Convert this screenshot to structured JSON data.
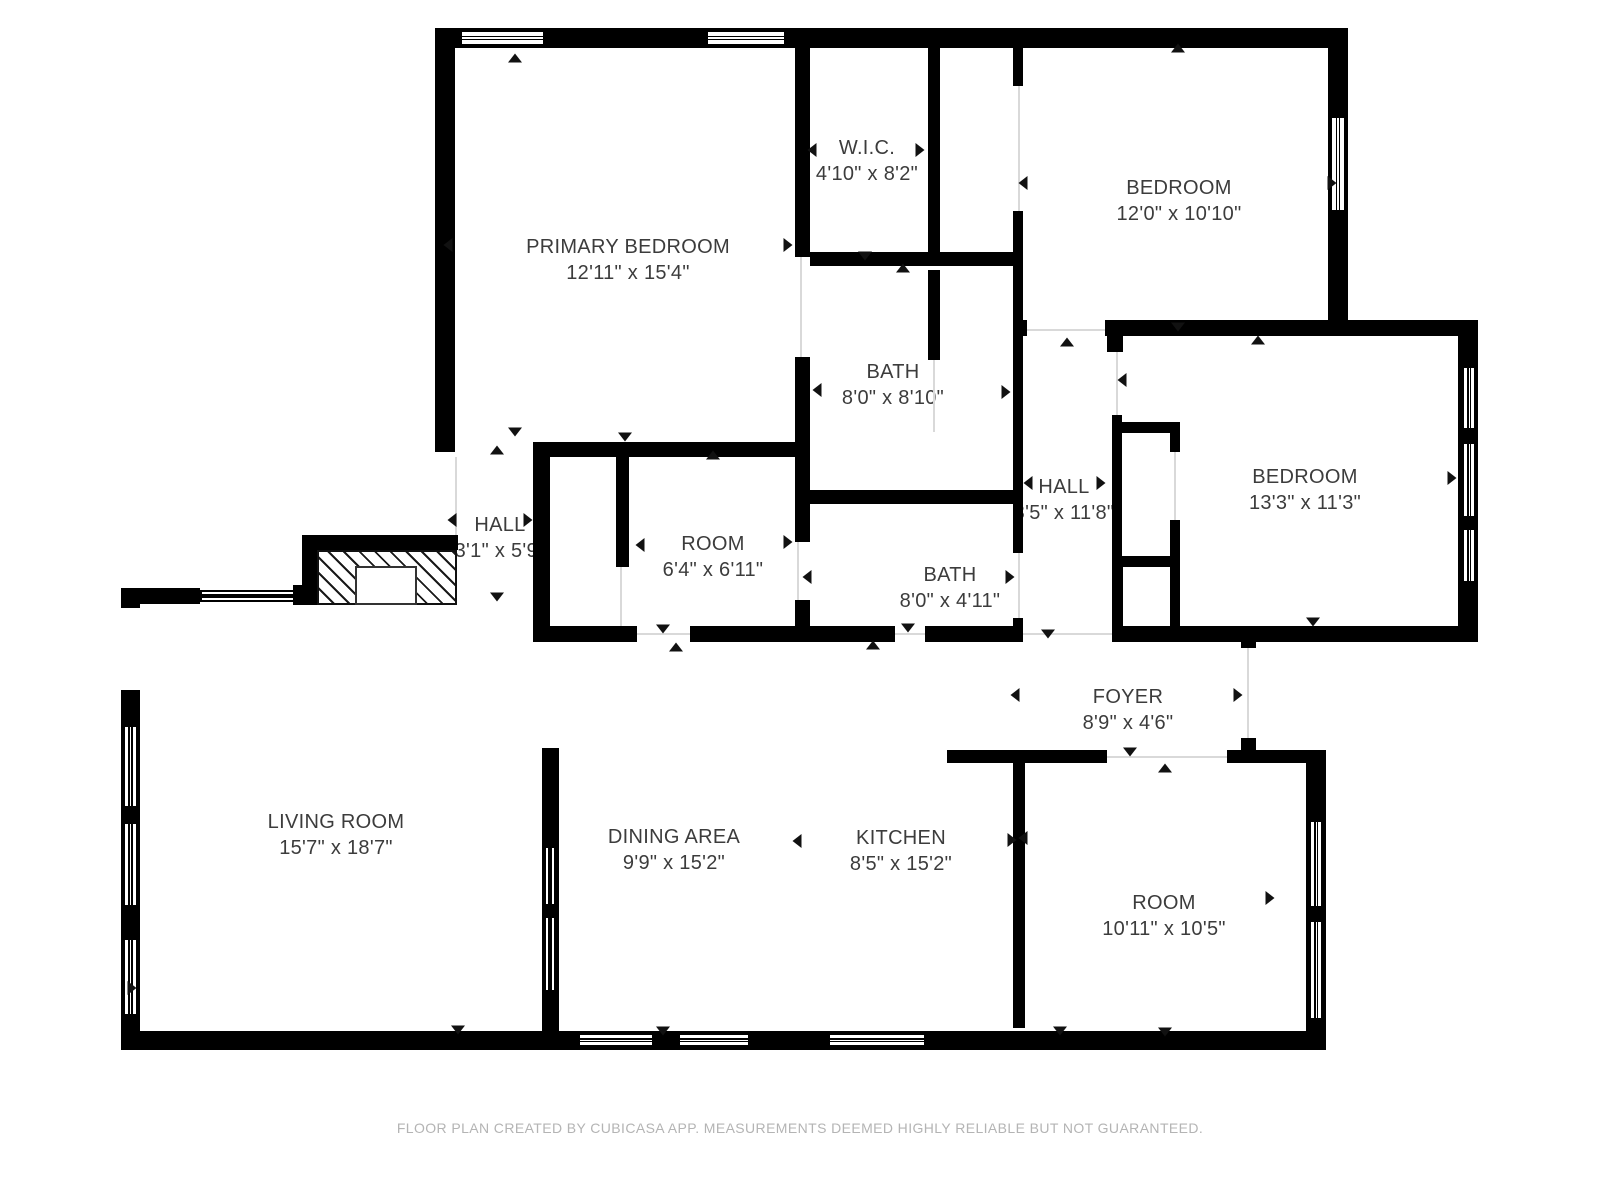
{
  "footer": {
    "text": "FLOOR PLAN CREATED BY CUBICASA APP. MEASUREMENTS DEEMED HIGHLY RELIABLE BUT NOT GUARANTEED."
  },
  "colors": {
    "wall": "#000000",
    "floor": "#ffffff",
    "label_text": "#3c3c3c",
    "marker": "#111111",
    "opening_line": "#d9d9d9",
    "footer_text": "#b4b4b4"
  },
  "rooms": [
    {
      "id": "primary-bedroom",
      "name": "PRIMARY BEDROOM",
      "dims": "12'11\" x 15'4\"",
      "cx": 628,
      "cy": 260
    },
    {
      "id": "wic",
      "name": "W.I.C.",
      "dims": "4'10\" x 8'2\"",
      "cx": 867,
      "cy": 161
    },
    {
      "id": "bedroom-top-right",
      "name": "BEDROOM",
      "dims": "12'0\" x 10'10\"",
      "cx": 1179,
      "cy": 201
    },
    {
      "id": "bath-upper",
      "name": "BATH",
      "dims": "8'0\" x 8'10\"",
      "cx": 893,
      "cy": 385
    },
    {
      "id": "hall-right",
      "name": "HALL",
      "dims": "3'5\" x 11'8\"",
      "cx": 1064,
      "cy": 500
    },
    {
      "id": "bedroom-right",
      "name": "BEDROOM",
      "dims": "13'3\" x 11'3\"",
      "cx": 1305,
      "cy": 490
    },
    {
      "id": "hall-left",
      "name": "HALL",
      "dims": "3'1\" x 5'9\"",
      "cx": 500,
      "cy": 538
    },
    {
      "id": "room-small",
      "name": "ROOM",
      "dims": "6'4\" x 6'11\"",
      "cx": 713,
      "cy": 557
    },
    {
      "id": "bath-lower",
      "name": "BATH",
      "dims": "8'0\" x 4'11\"",
      "cx": 950,
      "cy": 588
    },
    {
      "id": "foyer",
      "name": "FOYER",
      "dims": "8'9\" x 4'6\"",
      "cx": 1128,
      "cy": 710
    },
    {
      "id": "living-room",
      "name": "LIVING ROOM",
      "dims": "15'7\" x 18'7\"",
      "cx": 336,
      "cy": 835
    },
    {
      "id": "dining-area",
      "name": "DINING AREA",
      "dims": "9'9\" x 15'2\"",
      "cx": 674,
      "cy": 850
    },
    {
      "id": "kitchen",
      "name": "KITCHEN",
      "dims": "8'5\" x 15'2\"",
      "cx": 901,
      "cy": 851
    },
    {
      "id": "room-lower",
      "name": "ROOM",
      "dims": "10'11\" x 10'5\"",
      "cx": 1164,
      "cy": 916
    }
  ],
  "plan": {
    "walls": [
      [
        435,
        28,
        913,
        20
      ],
      [
        435,
        28,
        20,
        424
      ],
      [
        1328,
        28,
        20,
        308
      ],
      [
        1105,
        320,
        373,
        16
      ],
      [
        1013,
        320,
        14,
        16
      ],
      [
        1458,
        320,
        20,
        322
      ],
      [
        1112,
        626,
        366,
        16
      ],
      [
        795,
        48,
        15,
        209
      ],
      [
        795,
        357,
        15,
        100
      ],
      [
        928,
        28,
        12,
        230
      ],
      [
        928,
        270,
        12,
        90
      ],
      [
        1013,
        28,
        10,
        58
      ],
      [
        1013,
        211,
        10,
        109
      ],
      [
        1013,
        336,
        10,
        217
      ],
      [
        1013,
        618,
        10,
        24
      ],
      [
        810,
        252,
        213,
        14
      ],
      [
        795,
        490,
        228,
        14
      ],
      [
        533,
        442,
        277,
        15
      ],
      [
        533,
        457,
        17,
        185
      ],
      [
        616,
        457,
        13,
        110
      ],
      [
        795,
        457,
        15,
        85
      ],
      [
        795,
        600,
        15,
        42
      ],
      [
        533,
        626,
        104,
        16
      ],
      [
        690,
        626,
        205,
        16
      ],
      [
        925,
        626,
        98,
        16
      ],
      [
        1107,
        336,
        16,
        16
      ],
      [
        1112,
        415,
        10,
        152
      ],
      [
        1112,
        567,
        11,
        59
      ],
      [
        1112,
        422,
        68,
        11
      ],
      [
        1170,
        422,
        10,
        30
      ],
      [
        1170,
        520,
        10,
        47
      ],
      [
        1112,
        556,
        68,
        11
      ],
      [
        1170,
        567,
        10,
        59
      ],
      [
        1241,
        628,
        15,
        20
      ],
      [
        1241,
        738,
        15,
        14
      ],
      [
        947,
        750,
        160,
        13
      ],
      [
        1227,
        750,
        99,
        13
      ],
      [
        1306,
        750,
        20,
        300
      ],
      [
        1013,
        750,
        12,
        278
      ],
      [
        121,
        588,
        79,
        16
      ],
      [
        121,
        588,
        19,
        462
      ],
      [
        121,
        1031,
        1205,
        19
      ],
      [
        542,
        748,
        17,
        285
      ]
    ],
    "holes": [
      [
        121,
        608,
        19,
        82
      ]
    ],
    "windows": [
      [
        460,
        30,
        85,
        16,
        "h"
      ],
      [
        706,
        30,
        80,
        16,
        "h"
      ],
      [
        1330,
        116,
        16,
        96,
        "v"
      ],
      [
        1462,
        366,
        14,
        64,
        "v"
      ],
      [
        1462,
        442,
        14,
        76,
        "v"
      ],
      [
        1462,
        528,
        14,
        55,
        "v"
      ],
      [
        200,
        590,
        95,
        12,
        "h"
      ],
      [
        123,
        725,
        15,
        83,
        "v"
      ],
      [
        123,
        822,
        15,
        85,
        "v"
      ],
      [
        123,
        938,
        15,
        78,
        "v"
      ],
      [
        578,
        1033,
        76,
        14,
        "h"
      ],
      [
        678,
        1033,
        72,
        14,
        "h"
      ],
      [
        828,
        1033,
        98,
        14,
        "h"
      ],
      [
        1309,
        820,
        14,
        88,
        "v"
      ],
      [
        1309,
        920,
        14,
        100,
        "v"
      ],
      [
        544,
        846,
        12,
        60,
        "v"
      ],
      [
        544,
        916,
        12,
        76,
        "v"
      ]
    ],
    "openings": [
      [
        455,
        457,
        2,
        93
      ],
      [
        800,
        257,
        2,
        100
      ],
      [
        933,
        360,
        2,
        72
      ],
      [
        1018,
        86,
        2,
        125
      ],
      [
        1027,
        329,
        78,
        2
      ],
      [
        1116,
        352,
        2,
        63
      ],
      [
        1174,
        452,
        2,
        68
      ],
      [
        637,
        633,
        53,
        2
      ],
      [
        1018,
        553,
        2,
        65
      ],
      [
        1023,
        633,
        89,
        2
      ],
      [
        1107,
        756,
        120,
        2
      ],
      [
        895,
        633,
        30,
        2
      ],
      [
        797,
        542,
        2,
        58
      ],
      [
        620,
        567,
        2,
        59
      ],
      [
        125,
        608,
        2,
        82
      ],
      [
        1247,
        648,
        2,
        94
      ]
    ],
    "markers": [
      [
        515,
        58,
        "u"
      ],
      [
        1178,
        48,
        "u"
      ],
      [
        812,
        150,
        "l"
      ],
      [
        920,
        150,
        "r"
      ],
      [
        448,
        245,
        "l"
      ],
      [
        788,
        245,
        "r"
      ],
      [
        515,
        432,
        "d"
      ],
      [
        1023,
        183,
        "l"
      ],
      [
        1332,
        183,
        "r"
      ],
      [
        865,
        256,
        "d"
      ],
      [
        903,
        268,
        "u"
      ],
      [
        1067,
        342,
        "u"
      ],
      [
        1178,
        327,
        "d"
      ],
      [
        1122,
        380,
        "l"
      ],
      [
        1452,
        478,
        "r"
      ],
      [
        1258,
        340,
        "u"
      ],
      [
        1313,
        622,
        "d"
      ],
      [
        1028,
        483,
        "l"
      ],
      [
        1101,
        483,
        "r"
      ],
      [
        817,
        390,
        "l"
      ],
      [
        1006,
        392,
        "r"
      ],
      [
        452,
        520,
        "l"
      ],
      [
        528,
        520,
        "r"
      ],
      [
        497,
        450,
        "u"
      ],
      [
        497,
        597,
        "d"
      ],
      [
        640,
        545,
        "l"
      ],
      [
        788,
        542,
        "r"
      ],
      [
        625,
        437,
        "d"
      ],
      [
        713,
        455,
        "u"
      ],
      [
        663,
        629,
        "d"
      ],
      [
        676,
        647,
        "u"
      ],
      [
        807,
        577,
        "l"
      ],
      [
        1010,
        577,
        "r"
      ],
      [
        908,
        628,
        "d"
      ],
      [
        873,
        645,
        "u"
      ],
      [
        1048,
        634,
        "d"
      ],
      [
        1015,
        695,
        "l"
      ],
      [
        1238,
        695,
        "r"
      ],
      [
        1130,
        752,
        "d"
      ],
      [
        1165,
        768,
        "u"
      ],
      [
        1023,
        838,
        "l"
      ],
      [
        1270,
        898,
        "r"
      ],
      [
        1165,
        1032,
        "d"
      ],
      [
        132,
        988,
        "r"
      ],
      [
        797,
        841,
        "l"
      ],
      [
        1012,
        840,
        "r"
      ],
      [
        663,
        1031,
        "d"
      ],
      [
        1060,
        1031,
        "d"
      ],
      [
        458,
        1030,
        "d"
      ]
    ],
    "fireplace": {
      "bars": [
        [
          302,
          535,
          156,
          15
        ],
        [
          302,
          535,
          15,
          70
        ],
        [
          293,
          585,
          22,
          20
        ]
      ],
      "hatch": [
        317,
        550,
        140,
        55
      ],
      "inner": [
        355,
        566,
        62,
        39
      ]
    }
  }
}
